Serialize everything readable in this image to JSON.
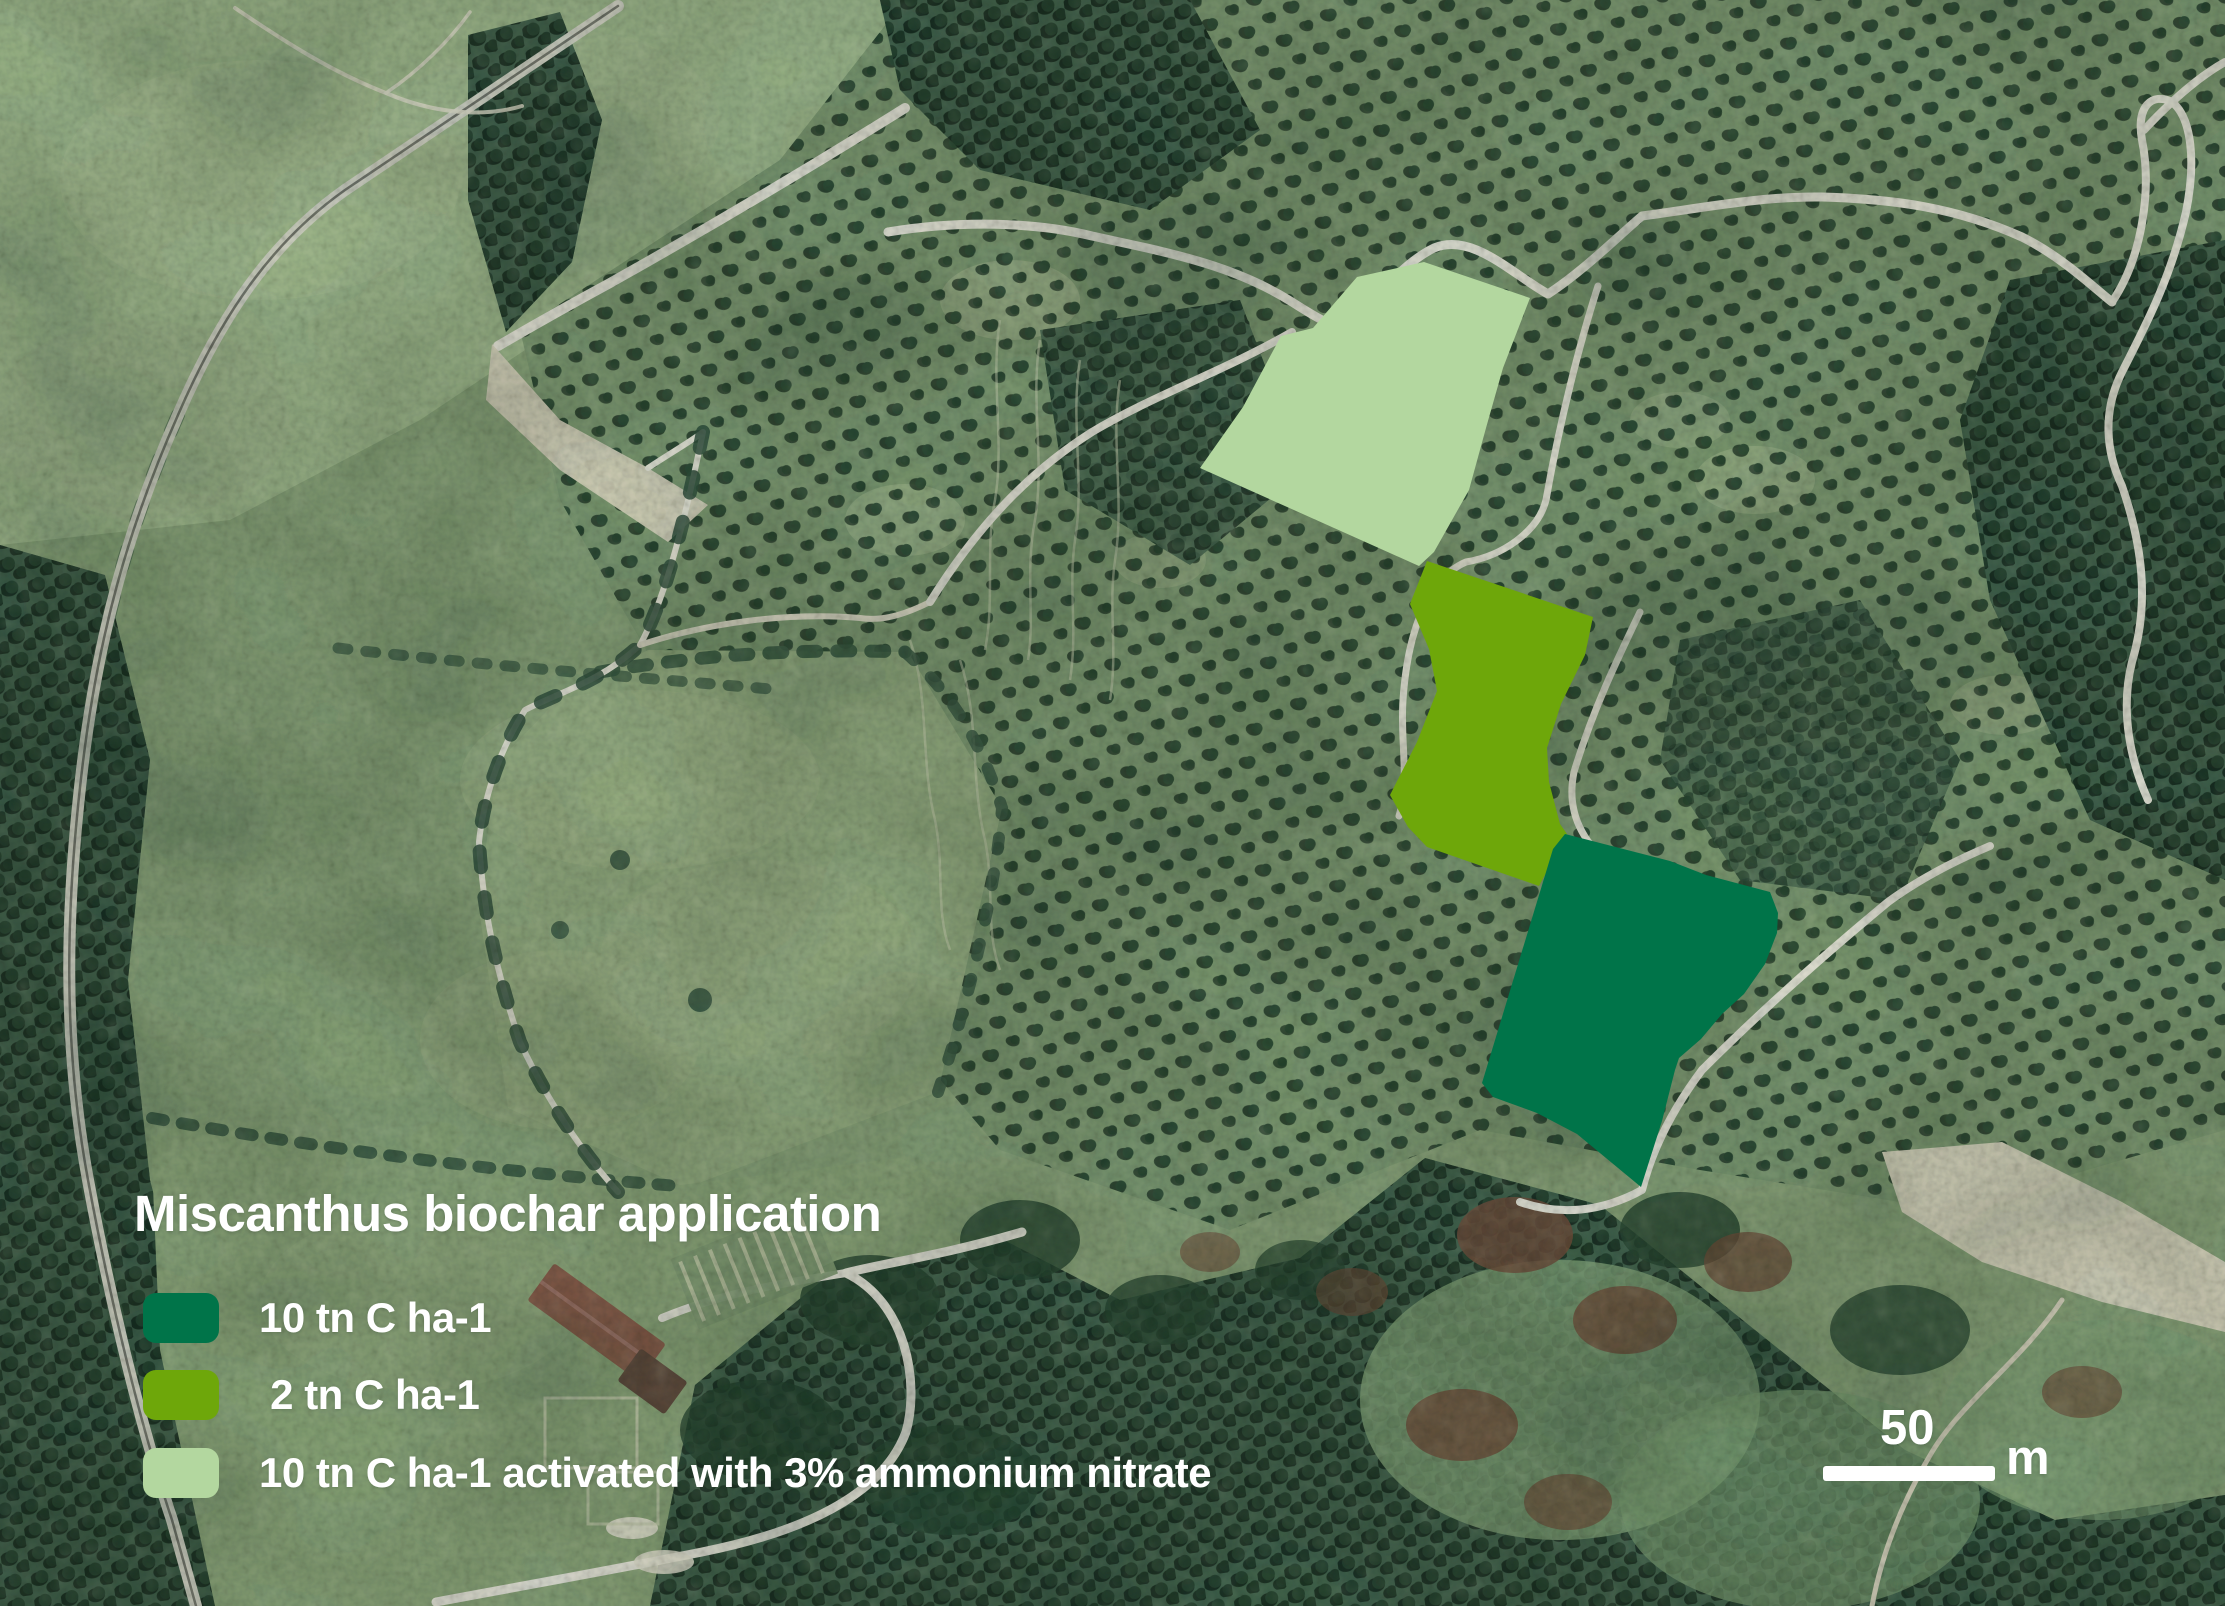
{
  "map": {
    "title": "Miscanthus biochar application",
    "legend": {
      "items": [
        {
          "id": "plot-10tn",
          "label": "10 tn C ha-1",
          "color": "#007449"
        },
        {
          "id": "plot-2tn",
          "label": " 2 tn C ha-1",
          "color": "#6ea70a"
        },
        {
          "id": "plot-10tn-activated",
          "label": "10 tn C ha-1 activated with 3% ammonium nitrate",
          "color": "#b3d79f"
        }
      ]
    },
    "scale_bar": {
      "distance": "50",
      "unit": "m"
    },
    "overlays": {
      "plot_10tn": {
        "color": "#007449",
        "points": "1565,834 1670,861 1706,875 1770,892 1778,913 1777,933 1765,964 1744,994 1722,1014 1701,1039 1679,1058 1675,1070 1662,1121 1641,1187 1577,1134 1537,1113 1493,1097 1482,1083 1553,849"
      },
      "plot_2tn": {
        "color": "#6ea70a",
        "points": "1427,561 1593,617 1585,655 1561,704 1547,748 1549,782 1560,824 1567,834 1539,886 1427,847 1408,827 1390,795 1417,742 1437,691 1429,649 1410,604"
      },
      "plot_10tn_activated": {
        "color": "#b3d79f",
        "points": "1424,262 1530,298 1503,368 1486,428 1469,490 1434,552 1419,566 1200,468 1243,407 1281,336 1313,328 1357,277"
      }
    }
  }
}
